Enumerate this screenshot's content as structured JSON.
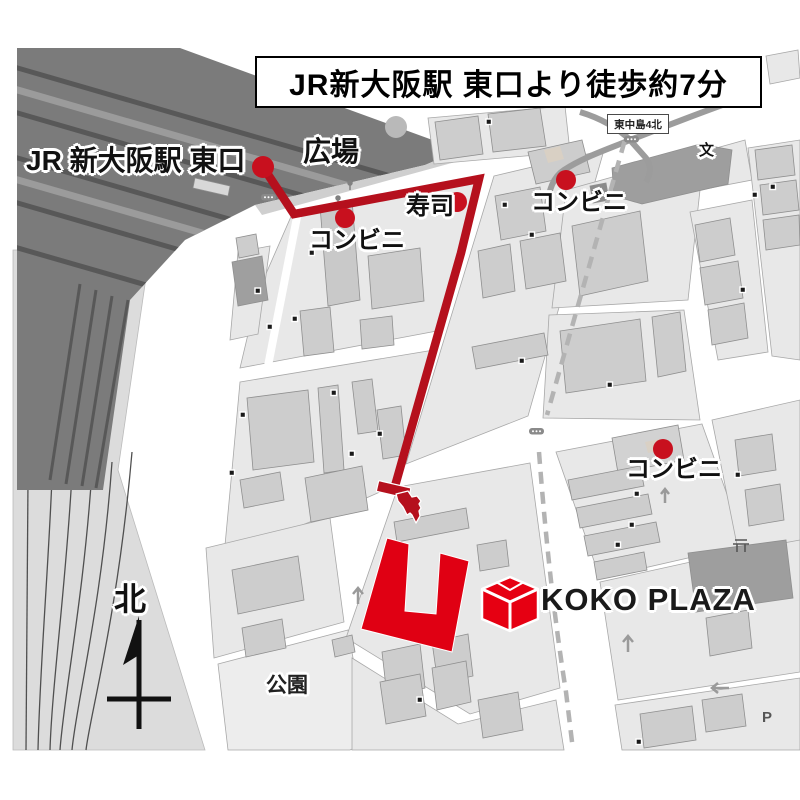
{
  "header": {
    "title": "JR新大阪駅 東口より徒歩約7分"
  },
  "station": {
    "label": "JR 新大阪駅  東口",
    "plaza_label": "広場"
  },
  "pois": [
    {
      "id": "convenience-store-1",
      "label": "コンビニ"
    },
    {
      "id": "sushi-restaurant",
      "label": "寿司"
    },
    {
      "id": "convenience-store-2",
      "label": "コンビニ"
    },
    {
      "id": "convenience-store-3",
      "label": "コンビニ"
    }
  ],
  "destination": {
    "name": "KOKO PLAZA"
  },
  "map_marks": {
    "north": "北",
    "park": "公園",
    "intersection_sign": "東中島4北",
    "school_mark": "文",
    "parking_mark": "P"
  },
  "colors": {
    "route": "#b5101d",
    "poi_dot": "#c8101e",
    "destination_building": "#e00013",
    "logo": "#e60012"
  }
}
